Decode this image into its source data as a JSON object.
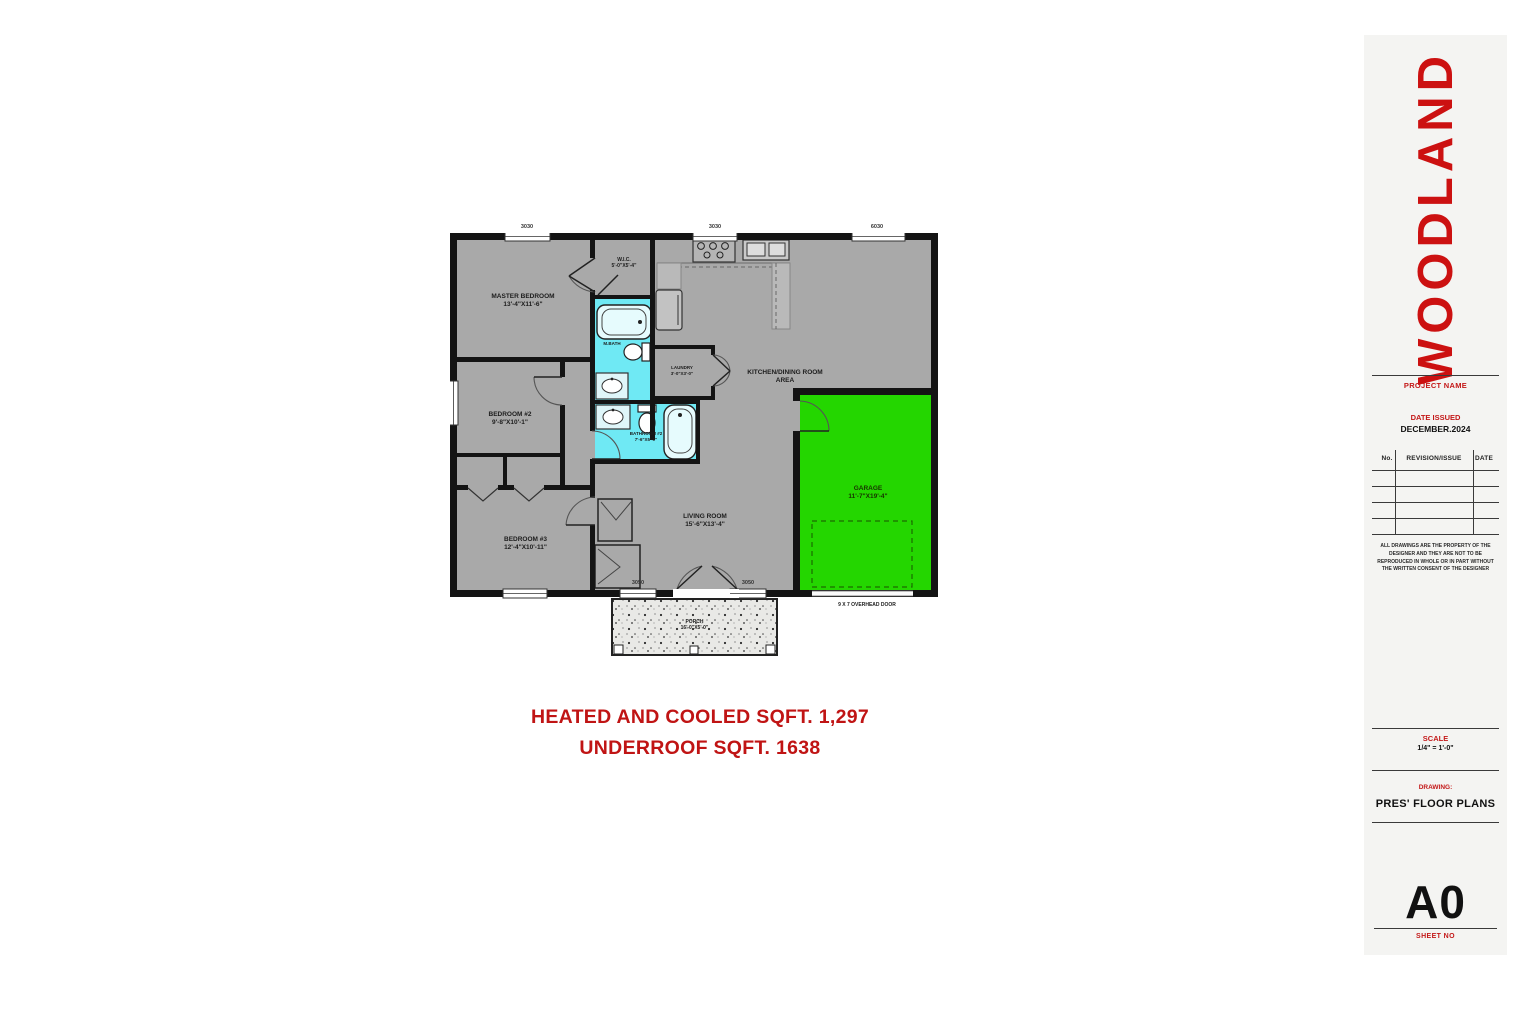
{
  "colors": {
    "accent_red": "#c41414",
    "floor_gray": "#a9a9a9",
    "bath_cyan": "#6fe9f4",
    "garage_green": "#24d600",
    "wall_black": "#141414"
  },
  "title_block": {
    "brand": "WOODLAND",
    "project_name_label": "PROJECT NAME",
    "date_issued_label": "DATE ISSUED",
    "date_issued_value": "DECEMBER.2024",
    "revision_table": {
      "no_header": "No.",
      "revision_header": "REVISION/ISSUE",
      "date_header": "DATE"
    },
    "disclaimer": "ALL DRAWINGS ARE THE PROPERTY OF THE DESIGNER AND THEY ARE NOT TO BE REPRODUCED IN WHOLE OR IN PART WITHOUT THE WRITTEN CONSENT OF THE DESIGNER",
    "scale_label": "SCALE",
    "scale_value": "1/4\" = 1'-0\"",
    "drawing_label": "DRAWING:",
    "drawing_value": "PRES' FLOOR PLANS",
    "sheet_number": "A0",
    "sheet_no_label": "SHEET NO"
  },
  "summary": {
    "line1": "HEATED AND COOLED SQFT. 1,297",
    "line2": "UNDERROOF SQFT. 1638"
  },
  "plan": {
    "rooms": [
      {
        "name": "MASTER BEDROOM",
        "dims": "13'-4\"X11'-6\""
      },
      {
        "name": "W.I.C.",
        "dims": "5'-0\"X5'-4\""
      },
      {
        "name": "M.BATH",
        "dims": "5'-0\"X8'-0\""
      },
      {
        "name": "LAUNDRY",
        "dims": "3'-0\"X3'-0\""
      },
      {
        "name": "BATHROOM #2",
        "dims": "7'-6\"X5'-0\""
      },
      {
        "name": "BEDROOM #2",
        "dims": "9'-8\"X10'-1\""
      },
      {
        "name": "BEDROOM #3",
        "dims": "12'-4\"X10'-11\""
      },
      {
        "name": "LIVING ROOM",
        "dims": "15'-6\"X13'-4\""
      },
      {
        "name": "KITCHEN/DINING ROOM",
        "dims": "AREA"
      },
      {
        "name": "GARAGE",
        "dims": "11'-7\"X19'-4\""
      },
      {
        "name": "PORCH",
        "dims": "16'-0\"X5'-0\""
      }
    ],
    "overhead_door_note": "9 X 7 OVERHEAD DOOR",
    "window_labels": [
      "3030",
      "3030",
      "6030",
      "3050",
      "3050"
    ]
  }
}
